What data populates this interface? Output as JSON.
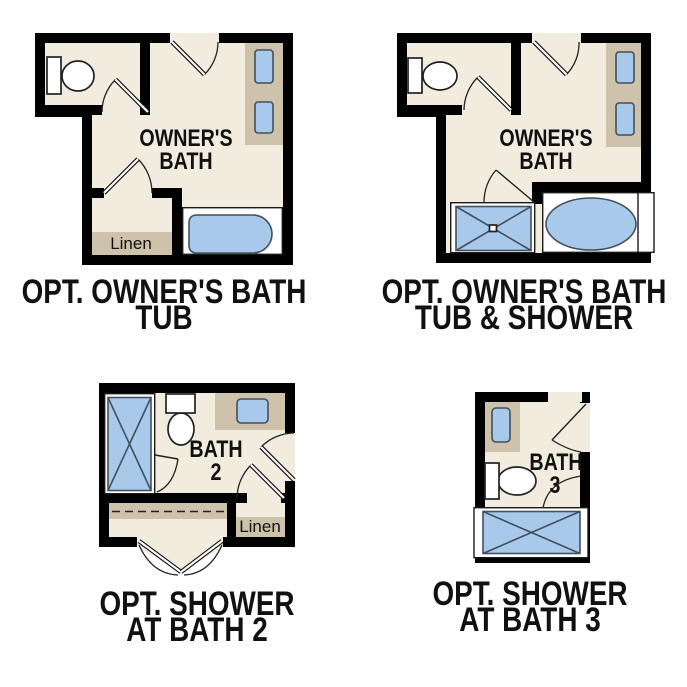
{
  "figure": {
    "type": "bathroom-floor-plan-options",
    "background": "#ffffff"
  },
  "colors": {
    "wall": "#000000",
    "floor": "#f2ecdf",
    "cabinet": "#cec3aa",
    "fixture_fill": "#a8c9e9",
    "fixture_stroke": "#42505f",
    "text": "#111111",
    "surround": "#ffffff"
  },
  "plans": [
    {
      "name": "opt-owners-bath-tub",
      "room_label": [
        "OWNER'S",
        "BATH"
      ],
      "closet_label": "Linen",
      "title": [
        "OPT. OWNER'S BATH",
        "TUB"
      ]
    },
    {
      "name": "opt-owners-bath-tub-shower",
      "room_label": [
        "OWNER'S",
        "BATH"
      ],
      "title": [
        "OPT. OWNER'S BATH",
        "TUB & SHOWER"
      ]
    },
    {
      "name": "opt-shower-at-bath-2",
      "room_label": [
        "BATH",
        "2"
      ],
      "closet_label": "Linen",
      "title": [
        "OPT. SHOWER",
        "AT BATH 2"
      ]
    },
    {
      "name": "opt-shower-at-bath-3",
      "room_label": [
        "BATH",
        "3"
      ],
      "title": [
        "OPT. SHOWER",
        "AT BATH 3"
      ]
    }
  ]
}
